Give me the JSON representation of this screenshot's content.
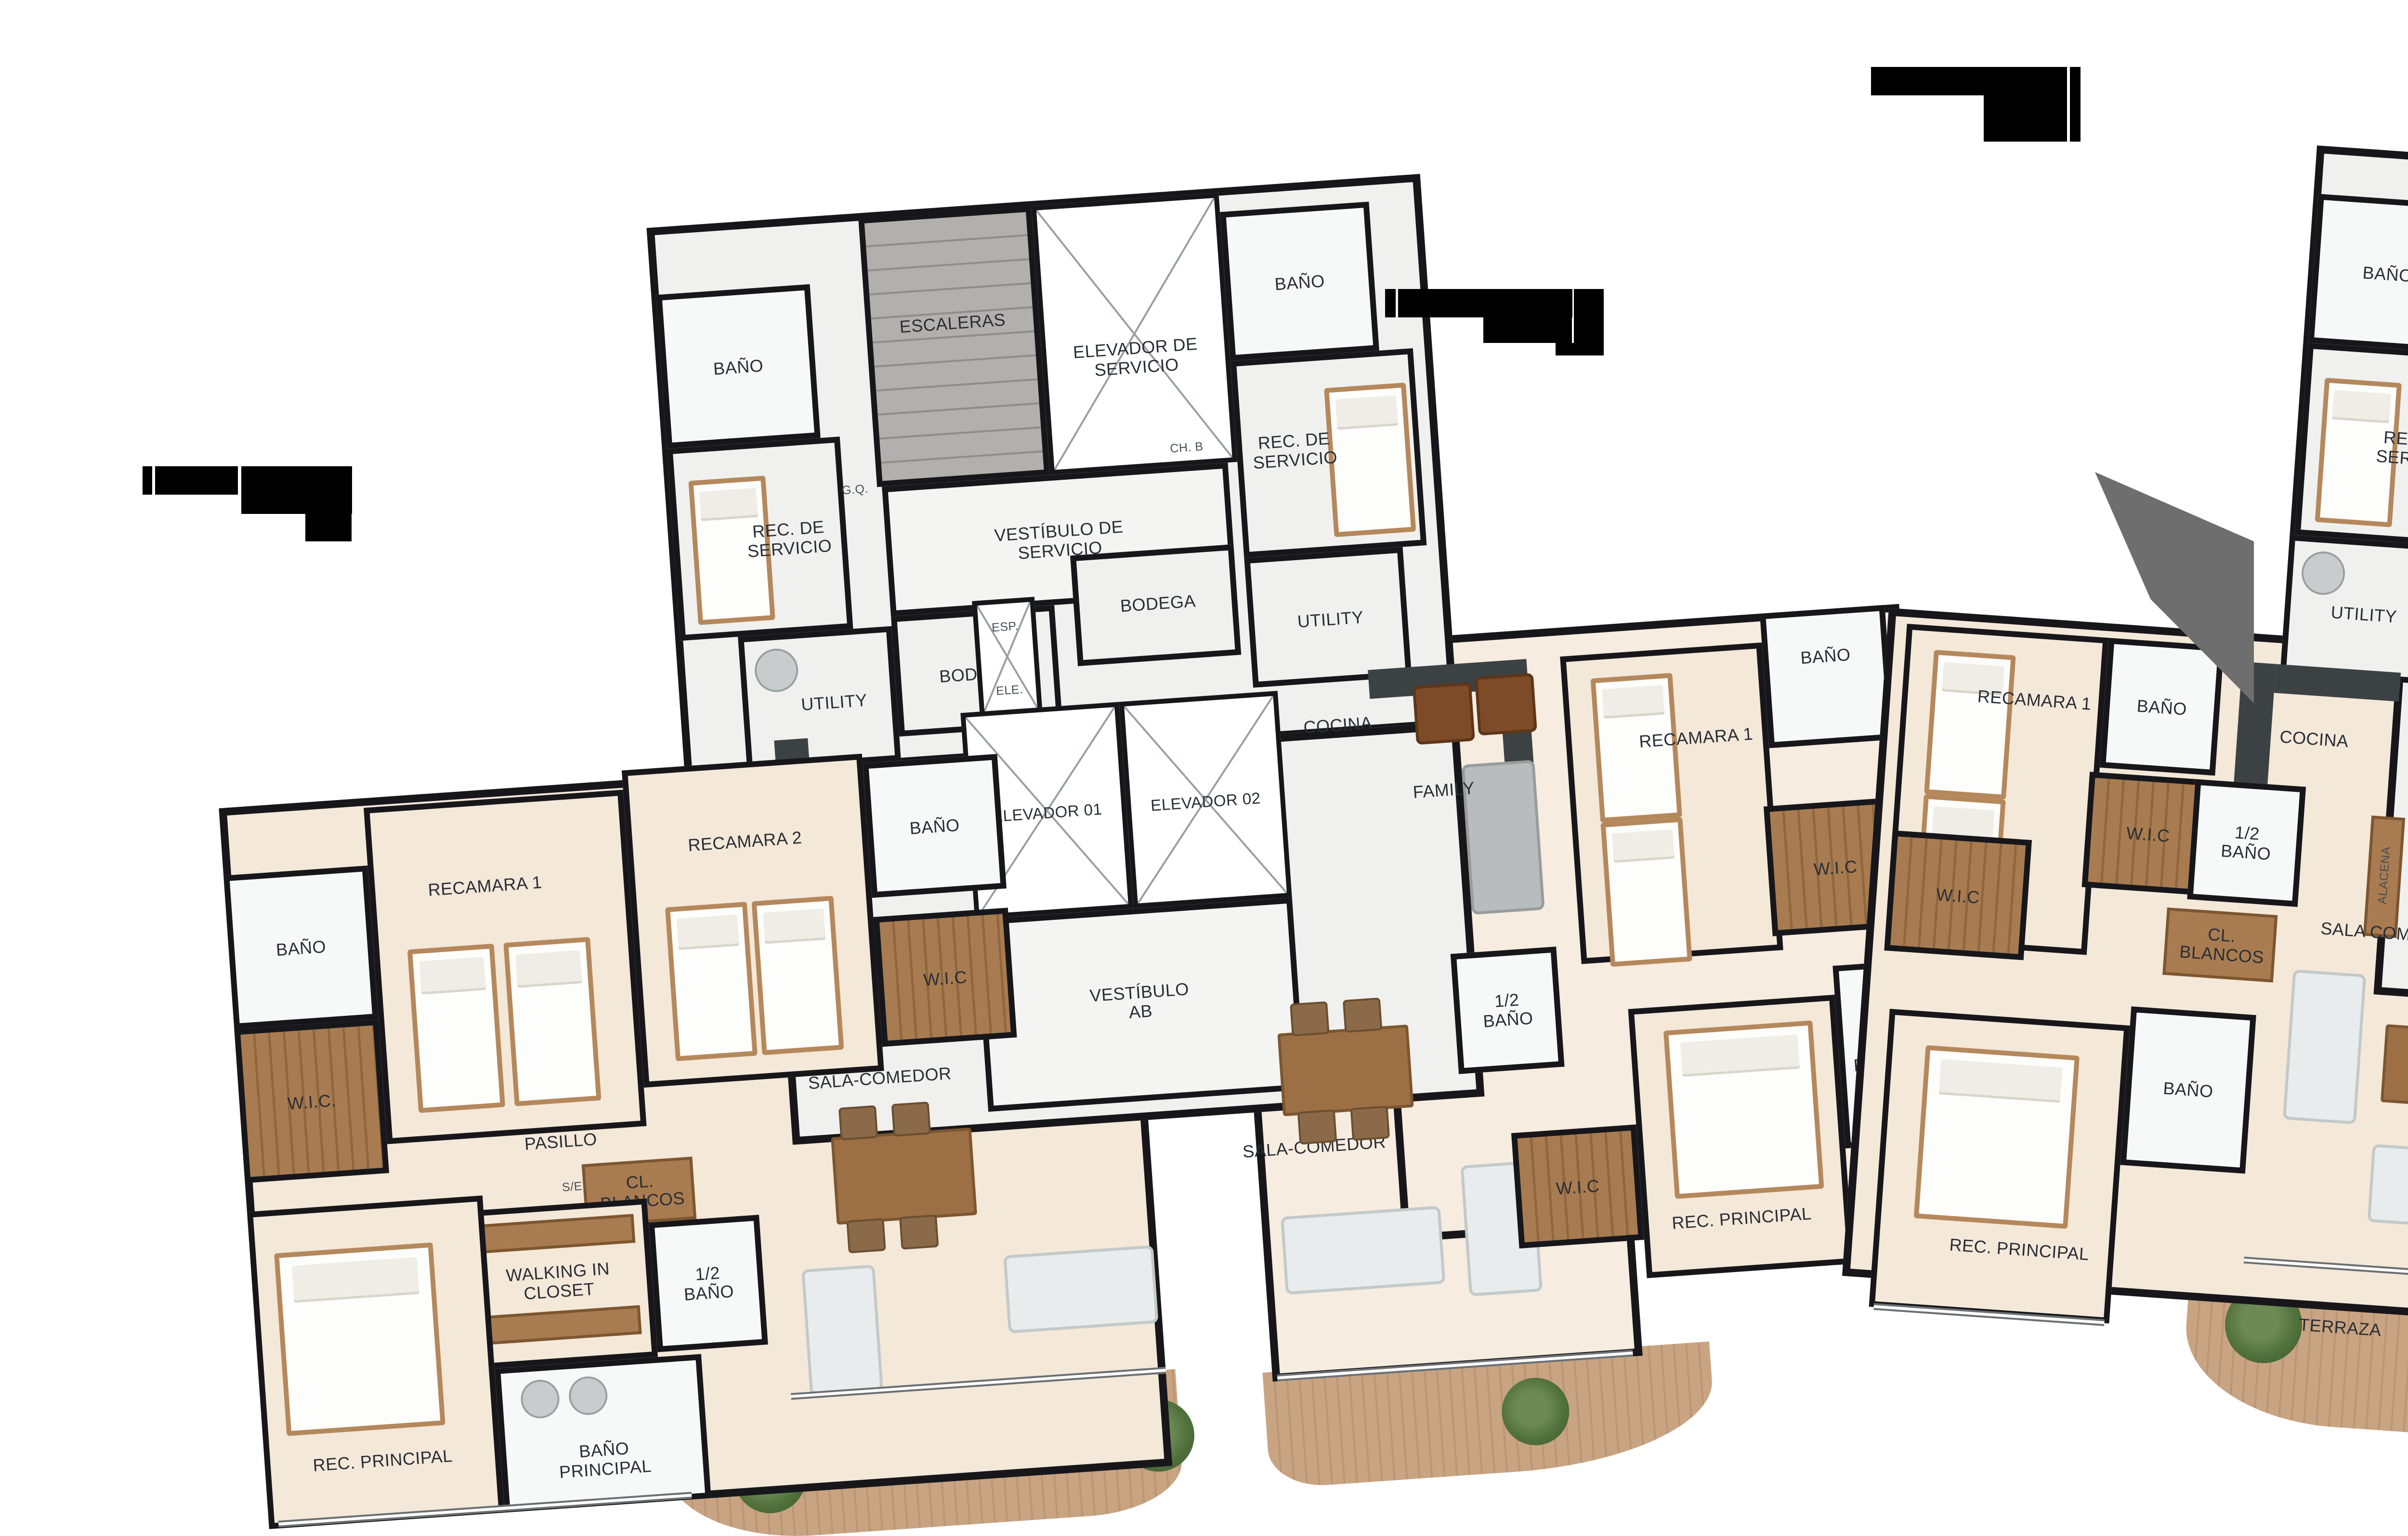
{
  "colors": {
    "wall": "#17171b",
    "floor_apartment": "#f4e8d9",
    "floor_service": "#f0f1ef",
    "stairs_gray": "#b2b0ac",
    "closet_wood": "#a87c50",
    "terrace_deck": "#c9a482",
    "counter_dark": "#3c4144",
    "label_text": "#2a2d35",
    "redaction": "#000000"
  },
  "labels": {
    "ab": {
      "core": {
        "escaleras": "ESCALERAS",
        "elevador_servicio": "ELEVADOR DE SERVICIO",
        "bano_izq": "BAÑO",
        "rec_servicio_izq": "REC. DE SERVICIO",
        "bano_der": "BAÑO",
        "rec_servicio_der": "REC. DE SERVICIO",
        "vestibulo_servicio": "VESTÍBULO DE SERVICIO",
        "utility_izq": "UTILITY",
        "utility_der": "UTILITY",
        "bodega_izq": "BODEGA",
        "bodega_der": "BODEGA",
        "esp": "ESP.",
        "ele": "ELE.",
        "gq": "G.Q.",
        "ch_b": "CH. B",
        "cocina_a": "COCINA",
        "cocina_b": "COCINA",
        "alacena_a": "ALACENA",
        "alacena_b": "ALACENA",
        "elevador_01": "ELEVADOR 01",
        "elevador_02": "ELEVADOR 02",
        "vestibulo_ab": "VESTÍBULO AB"
      },
      "unit_a": {
        "bano_izq": "BAÑO",
        "wic_izq": "W.I.C.",
        "recamara_1": "RECAMARA 1",
        "recamara_2": "RECAMARA 2",
        "bano_der": "BAÑO",
        "wic_der": "W.I.C",
        "pasillo": "PASILLO",
        "cl_blancos": "CL. BLANCOS",
        "walking_in_closet": "WALKING IN CLOSET",
        "medio_bano": "1/2 BAÑO",
        "bano_principal": "BAÑO PRINCIPAL",
        "rec_principal": "REC. PRINCIPAL",
        "sala_comedor": "SALA-COMEDOR",
        "se": "S/E"
      },
      "unit_b": {
        "family": "FAMILY",
        "recamara_1": "RECAMARA 1",
        "bano": "BAÑO",
        "wic_1": "W.I.C",
        "sala_comedor": "SALA-COMEDOR",
        "medio_bano": "1/2 BAÑO",
        "wic_2": "W.I.C",
        "rec_principal": "REC. PRINCIPAL",
        "bano_principal": "BAÑO PRINCIPAL"
      }
    },
    "cd": {
      "core": {
        "bano_izq": "BAÑO",
        "rec_servicio_izq": "REC. DE SERVICIO",
        "elevador_servicio": "ELEVADOR DE SERVICIO",
        "escalera": "ESCALERA",
        "bano_der": "BAÑO",
        "rec_servicio_der": "REC. DE SERVICIO",
        "pci": "PCI",
        "ch_b": "CH. B",
        "gq": "G.Q.",
        "vestibulo_servicio": "VESTIBULO DE SERVICIO",
        "utility_izq": "UTILITY",
        "utility_der": "UTILITY",
        "bodega_izq": "BODEGA",
        "bodega_der": "BODEGA",
        "exp": "EXP.",
        "elec": "ELEC.",
        "elevador_03": "ELEVADOR 03",
        "elevador_04": "ELEVADOR 04",
        "vestibulo_cd": "VESTÍBULO CD",
        "cocina_c": "COCINA",
        "cocina_d": "COCINA",
        "alacena_c": "ALACENA",
        "alacena_d": "ALACENA"
      },
      "unit_c": {
        "recamara_1": "RECAMARA 1",
        "bano_1": "BAÑO",
        "wic_1": "W.I.C",
        "wic_2": "W.I.C",
        "medio_bano": "1/2 BAÑO",
        "cl_blancos": "CL. BLANCOS",
        "sala_comedor": "SALA COMEDOR",
        "rec_principal": "REC. PRINCIPAL",
        "bano_2": "BAÑO",
        "terraza": "TERRAZA"
      },
      "unit_d": {
        "bano_1": "BAÑO",
        "recamara_1": "RECAMARA 1",
        "recamara_2": "RECAMARA 2",
        "bano_2": "BAÑO",
        "wic_1": "W.I.C",
        "wic_2": "W.I.C",
        "medio_bano": "1/2 BAÑO",
        "cl_blancos": "CL. BLANCOS",
        "walk_in_closet": "WALK IN CLOSET",
        "family": "FAMILY",
        "bano_3": "BAÑO",
        "rec_principal": "REC. PRINCIPAL",
        "sala_comedor": "SALA COMEDOR",
        "se": "S/E"
      }
    }
  }
}
